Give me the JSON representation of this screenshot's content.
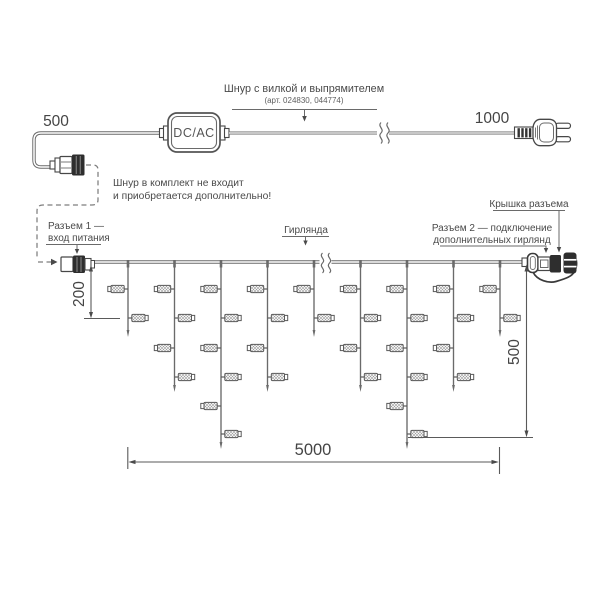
{
  "figure": {
    "type": "technical-diagram",
    "subject": "icicle garland wiring scheme"
  },
  "labels": {
    "top_cord": {
      "title": "Шнур с вилкой и выпрямителем",
      "subtitle": "(арт. 024830, 044774)"
    },
    "note": {
      "line1": "Шнур в комплект не входит",
      "line2": "и приобретается дополнительно!"
    },
    "connector1": {
      "line1": "Разъем 1 —",
      "line2": "вход питания"
    },
    "garland": "Гирлянда",
    "connector_cover": "Крышка разъема",
    "connector2": {
      "line1": "Разъем 2 — подключение",
      "line2": "дополнительных гирлянд"
    },
    "adapter": "DC/AC"
  },
  "dimensions": {
    "cord_left": "500",
    "cord_right": "1000",
    "first_drop_height": "200",
    "max_drop_height": "500",
    "garland_length": "5000"
  },
  "colors": {
    "line": "#6a6a6a",
    "stroke": "#474747",
    "dark_fill": "#2e2e2e",
    "dim_line": "#5a5a5a",
    "text": "#4a4a4a",
    "hatch": "#9a9a9a"
  },
  "garland": {
    "main_line_y": 262,
    "light_rows": [
      289,
      318,
      348,
      377,
      406,
      434
    ],
    "drops": [
      {
        "x": 128.0,
        "tip": 337,
        "lights": 2
      },
      {
        "x": 174.5,
        "tip": 392,
        "lights": 4
      },
      {
        "x": 221.0,
        "tip": 449,
        "lights": 6
      },
      {
        "x": 267.5,
        "tip": 392,
        "lights": 4
      },
      {
        "x": 314.0,
        "tip": 337,
        "lights": 2
      },
      {
        "x": 360.5,
        "tip": 392,
        "lights": 4
      },
      {
        "x": 407.0,
        "tip": 449,
        "lights": 6
      },
      {
        "x": 453.5,
        "tip": 392,
        "lights": 4
      },
      {
        "x": 500.0,
        "tip": 337,
        "lights": 2
      }
    ]
  }
}
